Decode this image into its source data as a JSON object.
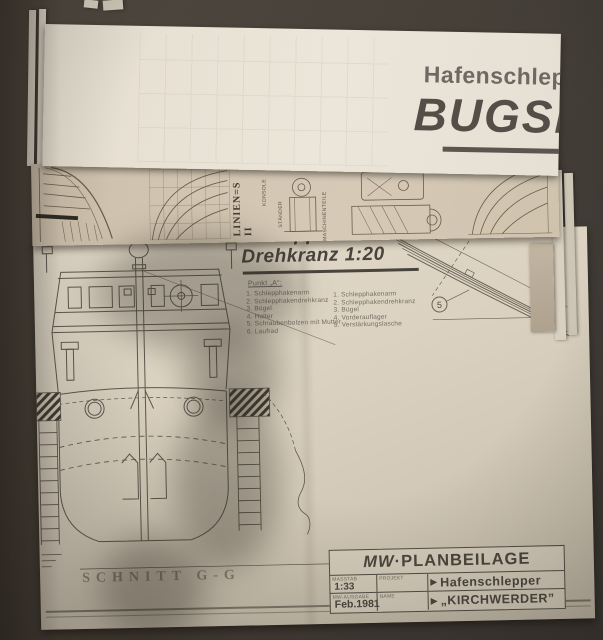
{
  "colors": {
    "background": "#46413b",
    "paper_white": "#e9e3d7",
    "paper_tan": "#cfc3ae",
    "ink_dark": "#534e46",
    "ink_light": "#746d62"
  },
  "top_sheet": {
    "subtitle": "Hafenschlep",
    "title": "BUGSI"
  },
  "middle_sheet": {
    "vertical_label": "LINIEN=S II",
    "labels": [
      "KONSOLE",
      "STÄNDER",
      "MASCHINENTEILE"
    ]
  },
  "main_sheet": {
    "heading_line1": "Schlepphaken-",
    "heading_line2": "Drehkranz 1:20",
    "note": "Punkt „A“:",
    "parts_list_left": [
      "Schlepphakenarm",
      "Schlepphakendrehkranz",
      "Bügel",
      "Halter",
      "Schraubenbolzen mit Mutter",
      "Laufrad"
    ],
    "parts_list_right": [
      "Schlepphakenarm",
      "Schlepphakendrehkranz",
      "Bügel",
      "Vorderauflager",
      "Verstärkungslasche"
    ],
    "detail_callout": "5",
    "section_label": "SCHNITT  G-G",
    "title_block": {
      "header_mw": "MW",
      "header_rest": "·PLANBEILAGE",
      "row1": {
        "label1": "MASSTAB",
        "value1": "1:33",
        "label2": "PROJEKT",
        "arrow": "▶",
        "value2": "Hafenschlepper"
      },
      "row2": {
        "label1": "MW-AUSGABE",
        "value1": "Feb.1981",
        "label2": "NAME",
        "arrow": "▶",
        "value2": "„KIRCHWERDER”"
      }
    }
  }
}
